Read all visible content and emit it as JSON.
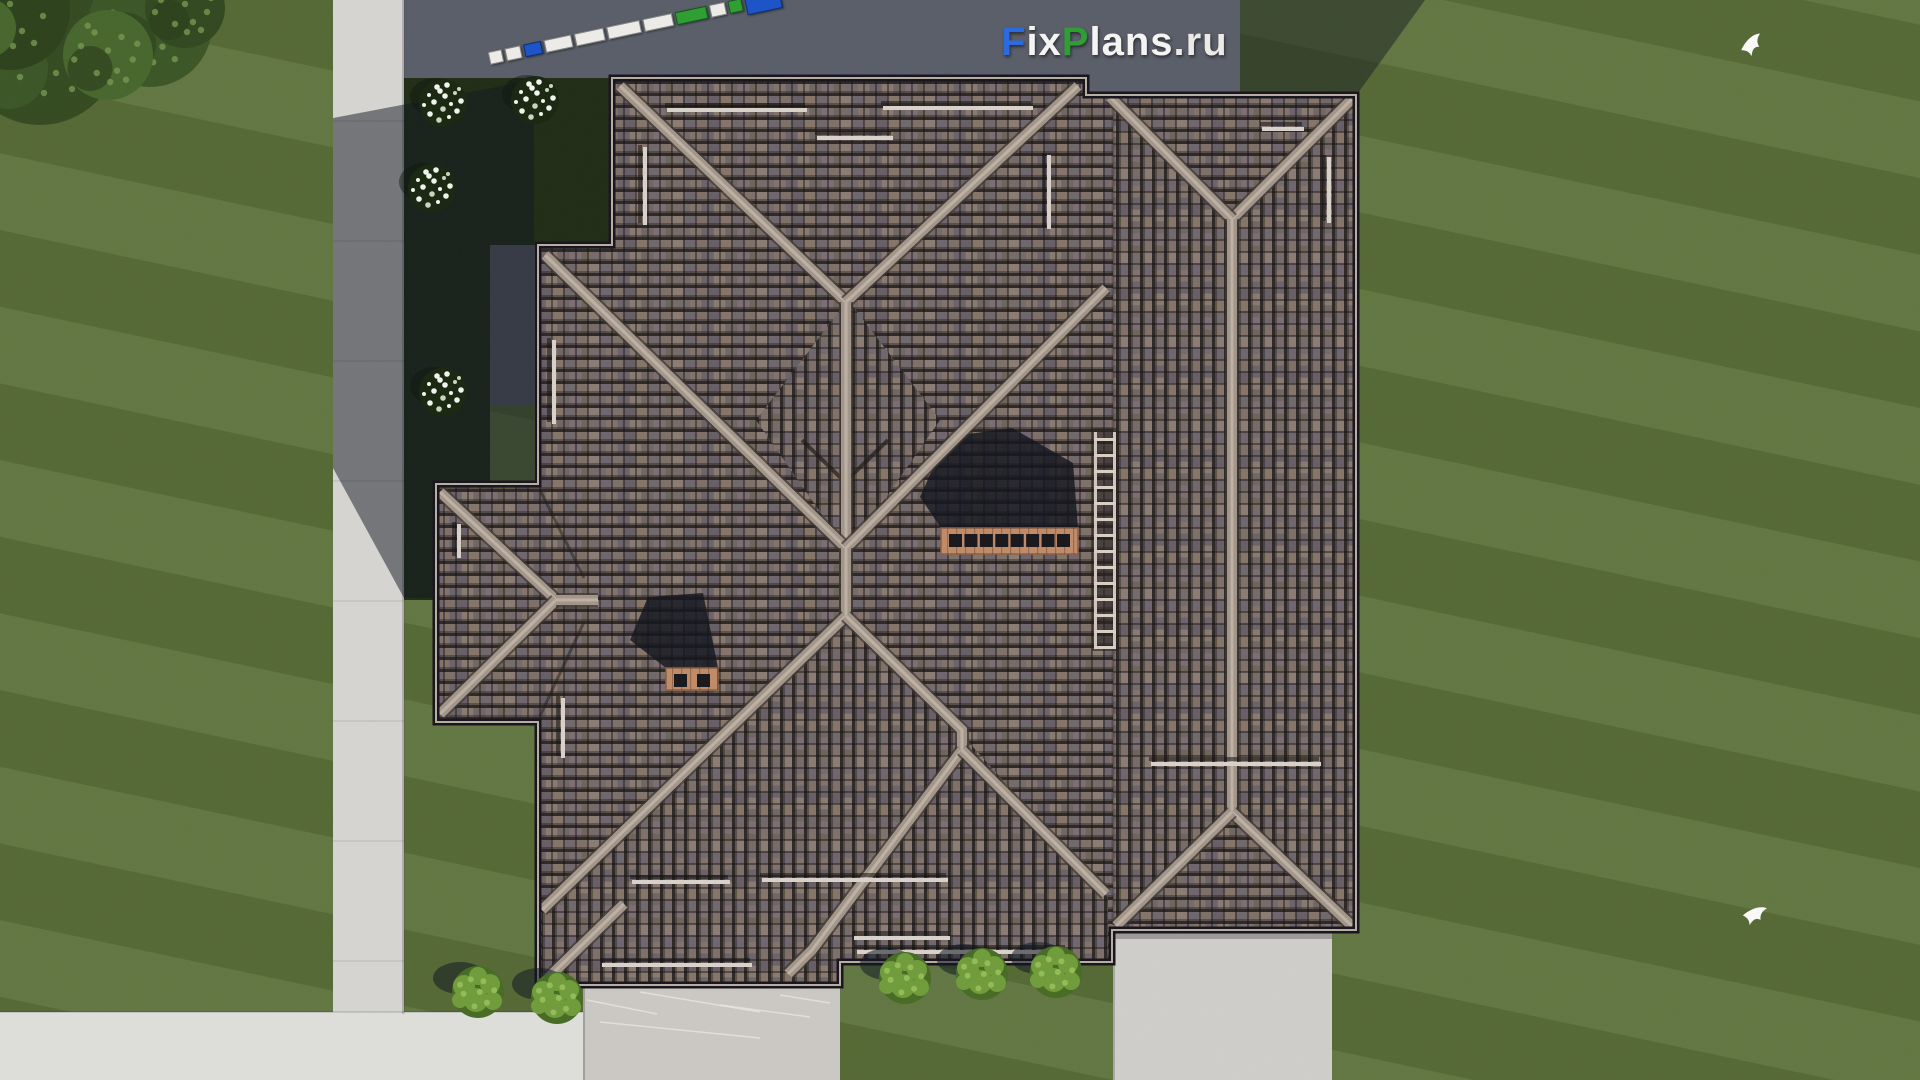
{
  "watermark": {
    "text": "FixPlans.ru",
    "x": 1001,
    "y": 20,
    "size": 40,
    "segments": [
      {
        "t": "F",
        "c": "#2b6adf"
      },
      {
        "t": "ix",
        "c": "#f4f4f2"
      },
      {
        "t": "P",
        "c": "#2f9e33"
      },
      {
        "t": "lans",
        "c": "#f4f4f2"
      },
      {
        "t": ".ru",
        "c": "#eceae8"
      }
    ]
  },
  "ruler": {
    "x": 489,
    "y": 46,
    "angle": -12,
    "colors": {
      "w": "#ecebe7",
      "b": "#1d55c8",
      "g": "#2f9e33"
    },
    "segments": [
      {
        "w": 12,
        "c": "w"
      },
      {
        "w": 14,
        "c": "w"
      },
      {
        "w": 16,
        "c": "b"
      },
      {
        "w": 26,
        "c": "w"
      },
      {
        "w": 28,
        "c": "w"
      },
      {
        "w": 32,
        "c": "w"
      },
      {
        "w": 28,
        "c": "w"
      },
      {
        "w": 30,
        "c": "g"
      },
      {
        "w": 14,
        "c": "w"
      },
      {
        "w": 12,
        "c": "g"
      },
      {
        "w": 34,
        "c": "b",
        "big": true
      }
    ]
  },
  "palette": {
    "lawn": "#596f37",
    "asphalt": "#585d68",
    "bed": "#1f2c15",
    "path": "#d6d5d1",
    "walk": "#dededa",
    "terrace": "#cbc8c3",
    "path_br": "#cfcecb",
    "tile_base": "#776a64",
    "tile_line": "#2c2725",
    "tile_tints": [
      "#8a7b73",
      "#6e656d",
      "#7d6f68",
      "#665e64",
      "#857468",
      "#70676a",
      "#7e7069"
    ],
    "tile_tints2": [
      "#74696b",
      "#81726b",
      "#6a6268",
      "#887970",
      "#6f6562",
      "#7b6d72",
      "#6d6459"
    ],
    "ridge": "#a2958a",
    "ridge_hi": "#beb1a4",
    "ridge_shadow": "#3f372f",
    "eave": "#16131a",
    "fascia": "#b6ada3",
    "valley": "#1d1916",
    "guard": "#d9d2ca",
    "chimney": "#c08a67",
    "chimney_hole": "#17161a",
    "chimney_joint": "#8a5f43",
    "ladder_rail": "#cfc6bd",
    "ladder_back": "#2a231f",
    "bush": "#466b22",
    "bush_hi": "#6f9c3a",
    "bush_dot": "#93bb55",
    "flower_bed": "#18260f",
    "flower": "#f2f4ee",
    "flower_dim": "#c9d6c0",
    "trees": [
      "#33491f",
      "#2c401b",
      "#3b5526",
      "#46662c",
      "#31471e"
    ],
    "tree_leaf": "#74964e",
    "shadow": "#0f1520",
    "bird": "#fafaf8"
  },
  "scene": {
    "ground": [
      {
        "x": 404,
        "y": 0,
        "w": 836,
        "h": 96,
        "fill": "asphalt"
      },
      {
        "x": 490,
        "y": 96,
        "w": 48,
        "h": 310,
        "fill": "asphalt"
      },
      {
        "x": 404,
        "y": 78,
        "w": 208,
        "h": 167,
        "fill": "bed"
      },
      {
        "x": 404,
        "y": 245,
        "w": 86,
        "h": 350,
        "fill": "bed"
      },
      {
        "x": 404,
        "y": 484,
        "w": 32,
        "h": 116,
        "fill": "bed"
      },
      {
        "x": 333,
        "y": 0,
        "w": 71,
        "h": 1014,
        "fill": "path"
      },
      {
        "x": 0,
        "y": 1012,
        "w": 583,
        "h": 68,
        "fill": "walk"
      },
      {
        "x": 583,
        "y": 985,
        "w": 257,
        "h": 95,
        "fill": "terrace"
      },
      {
        "x": 1113,
        "y": 930,
        "w": 219,
        "h": 150,
        "fill": "path_br"
      }
    ],
    "ground_shadows": [
      {
        "pts": [
          [
            333,
            118
          ],
          [
            534,
            80
          ],
          [
            534,
            598
          ],
          [
            404,
            598
          ],
          [
            333,
            468
          ]
        ],
        "o": 0.5
      },
      {
        "pts": [
          [
            1240,
            0
          ],
          [
            1425,
            0
          ],
          [
            1358,
            93
          ],
          [
            1240,
            93
          ]
        ],
        "o": 0.45
      }
    ],
    "roof": {
      "outline": [
        [
          612,
          78
        ],
        [
          1086,
          78
        ],
        [
          1086,
          95
        ],
        [
          1356,
          95
        ],
        [
          1356,
          930
        ],
        [
          1112,
          930
        ],
        [
          1112,
          962
        ],
        [
          840,
          962
        ],
        [
          840,
          985
        ],
        [
          538,
          985
        ],
        [
          538,
          722
        ],
        [
          436,
          722
        ],
        [
          436,
          484
        ],
        [
          538,
          484
        ],
        [
          538,
          245
        ],
        [
          612,
          245
        ]
      ],
      "vertical_tile_areas": [
        [
          [
            848,
            300
          ],
          [
            940,
            420
          ],
          [
            848,
            552
          ],
          [
            756,
            420
          ]
        ],
        [
          [
            848,
            618
          ],
          [
            965,
            738
          ],
          [
            1108,
            898
          ],
          [
            1108,
            962
          ],
          [
            840,
            962
          ],
          [
            840,
            985
          ],
          [
            542,
            985
          ],
          [
            542,
            912
          ]
        ],
        [
          [
            1113,
            95
          ],
          [
            1232,
            220
          ],
          [
            1232,
            812
          ],
          [
            1113,
            930
          ]
        ],
        [
          [
            1356,
            95
          ],
          [
            1232,
            220
          ],
          [
            1232,
            812
          ],
          [
            1356,
            930
          ]
        ]
      ],
      "ridges": [
        [
          [
            620,
            86
          ],
          [
            846,
            302
          ]
        ],
        [
          [
            1078,
            86
          ],
          [
            846,
            302
          ]
        ],
        [
          [
            846,
            302
          ],
          [
            846,
            548
          ]
        ],
        [
          [
            846,
            548
          ],
          [
            545,
            255
          ]
        ],
        [
          [
            846,
            548
          ],
          [
            1106,
            288
          ]
        ],
        [
          [
            846,
            548
          ],
          [
            846,
            616
          ]
        ],
        [
          [
            846,
            616
          ],
          [
            542,
            910
          ]
        ],
        [
          [
            846,
            616
          ],
          [
            962,
            730
          ],
          [
            962,
            750
          ]
        ],
        [
          [
            962,
            750
          ],
          [
            812,
            950
          ],
          [
            788,
            974
          ]
        ],
        [
          [
            962,
            750
          ],
          [
            1106,
            894
          ]
        ],
        [
          [
            548,
            978
          ],
          [
            624,
            904
          ]
        ],
        [
          [
            1352,
            99
          ],
          [
            1232,
            219
          ]
        ],
        [
          [
            1110,
            97
          ],
          [
            1232,
            219
          ]
        ],
        [
          [
            1232,
            219
          ],
          [
            1232,
            812
          ]
        ],
        [
          [
            1232,
            812
          ],
          [
            1352,
            926
          ]
        ],
        [
          [
            1232,
            812
          ],
          [
            1116,
            926
          ]
        ],
        [
          [
            440,
            492
          ],
          [
            556,
            600
          ]
        ],
        [
          [
            440,
            714
          ],
          [
            556,
            600
          ]
        ],
        [
          [
            556,
            600
          ],
          [
            598,
            600
          ]
        ]
      ],
      "valleys": [
        {
          "pts": [
            [
              802,
              440
            ],
            [
              845,
              482
            ],
            [
              888,
              440
            ]
          ],
          "w": 4,
          "o": 0.7
        },
        {
          "pts": [
            [
              884,
              652
            ],
            [
              952,
              720
            ]
          ],
          "w": 4,
          "o": 0.6
        },
        {
          "pts": [
            [
              1113,
              100
            ],
            [
              1113,
              925
            ]
          ],
          "w": 3,
          "o": 0.3
        },
        {
          "pts": [
            [
              540,
              490
            ],
            [
              584,
              578
            ]
          ],
          "w": 3,
          "o": 0.5
        },
        {
          "pts": [
            [
              540,
              716
            ],
            [
              584,
              622
            ]
          ],
          "w": 3,
          "o": 0.5
        }
      ],
      "snow_guards_h": [
        [
          667,
          108,
          140
        ],
        [
          883,
          106,
          150
        ],
        [
          817,
          136,
          76
        ],
        [
          1262,
          127,
          42
        ],
        [
          857,
          950,
          210
        ],
        [
          762,
          878,
          186
        ],
        [
          632,
          880,
          98
        ],
        [
          602,
          963,
          150
        ],
        [
          854,
          936,
          96
        ],
        [
          1151,
          762,
          170
        ]
      ],
      "snow_guards_v": [
        [
          643,
          147,
          78
        ],
        [
          1047,
          155,
          74
        ],
        [
          1327,
          157,
          66
        ],
        [
          552,
          340,
          84
        ],
        [
          561,
          698,
          60
        ],
        [
          457,
          524,
          34
        ]
      ],
      "ladder": {
        "x": 1094,
        "y": 432,
        "w": 22,
        "h": 215,
        "rung_gap": 16
      }
    },
    "chimneys": [
      {
        "x": 941,
        "y": 528,
        "w": 137,
        "h": 26,
        "holes": 8,
        "shadow": [
          [
            947,
            437
          ],
          [
            1012,
            428
          ],
          [
            1073,
            463
          ],
          [
            1078,
            528
          ],
          [
            941,
            528
          ],
          [
            920,
            497
          ]
        ]
      },
      {
        "x": 666,
        "y": 668,
        "w": 52,
        "h": 22,
        "holes": 2,
        "shadow": [
          [
            648,
            597
          ],
          [
            703,
            593
          ],
          [
            718,
            668
          ],
          [
            666,
            668
          ],
          [
            630,
            640
          ]
        ]
      }
    ],
    "plants": {
      "flower_shrubs": [
        [
          443,
          103
        ],
        [
          535,
          100
        ],
        [
          432,
          188
        ],
        [
          443,
          392
        ]
      ],
      "bushes": [
        [
          905,
          978
        ],
        [
          982,
          974
        ],
        [
          1056,
          972
        ],
        [
          478,
          992
        ],
        [
          557,
          998
        ]
      ],
      "trees": [
        [
          40,
          45,
          80
        ],
        [
          10,
          10,
          60
        ],
        [
          150,
          25,
          62
        ],
        [
          108,
          55,
          45
        ],
        [
          185,
          8,
          40
        ]
      ]
    },
    "birds": [
      {
        "x": 1738,
        "y": 38,
        "r": -15
      },
      {
        "x": 1745,
        "y": 903,
        "r": 10
      }
    ],
    "terrace_scratches": [
      [
        587,
        1000,
        70,
        14
      ],
      [
        640,
        992,
        120,
        20
      ],
      [
        720,
        1005,
        90,
        12
      ],
      [
        600,
        1022,
        160,
        16
      ],
      [
        780,
        995,
        50,
        8
      ]
    ]
  }
}
